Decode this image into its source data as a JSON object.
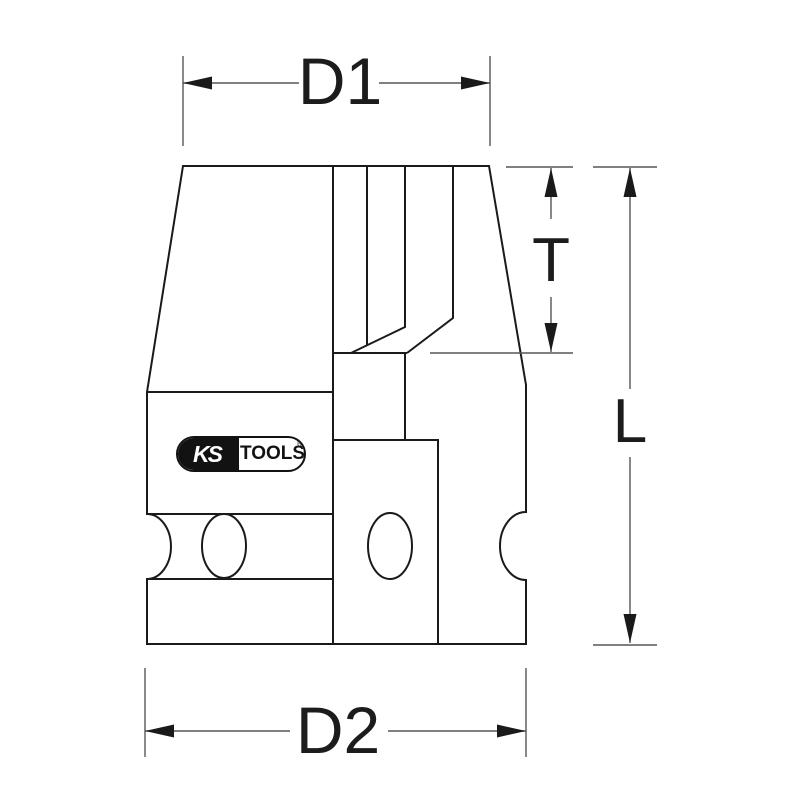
{
  "diagram": {
    "kind": "technical-dimension-drawing"
  },
  "dimensions": {
    "d1": "D1",
    "t": "T",
    "l": "L",
    "d2": "D2"
  },
  "logo": {
    "ks": "KS",
    "tools": "TOOLS",
    "registered": "®"
  },
  "colors": {
    "background": "#ffffff",
    "outline": "#1a1a1a",
    "dimension_line": "#565656",
    "label": "#1c1c1c",
    "logo_background": "#121212",
    "logo_text_on_dark": "#ffffff"
  }
}
